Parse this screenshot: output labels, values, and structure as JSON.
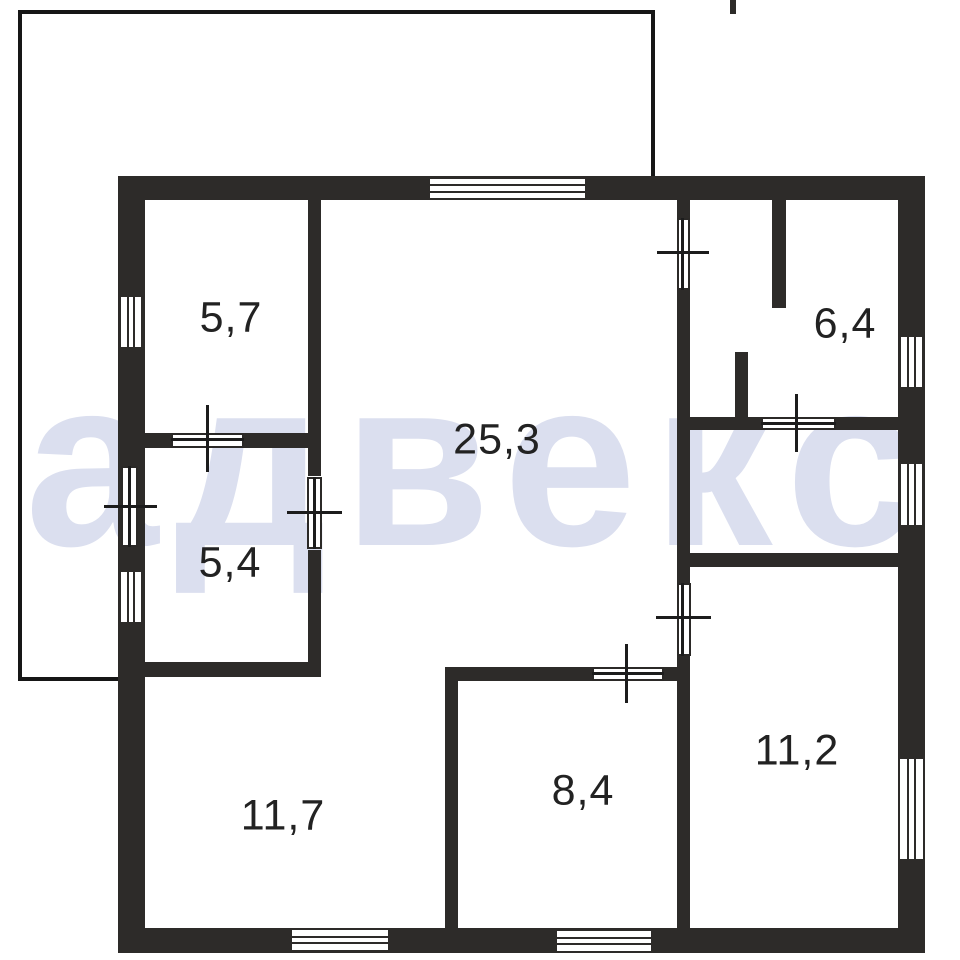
{
  "floor_plan": {
    "watermark": "адвекс",
    "rooms": [
      {
        "key": "5-7",
        "area": "5,7"
      },
      {
        "key": "25-3",
        "area": "25,3"
      },
      {
        "key": "6-4",
        "area": "6,4"
      },
      {
        "key": "5-4",
        "area": "5,4"
      },
      {
        "key": "11-7",
        "area": "11,7"
      },
      {
        "key": "8-4",
        "area": "8,4"
      },
      {
        "key": "11-2",
        "area": "11,2"
      }
    ],
    "colors": {
      "wall": "#2d2b29",
      "watermark": "#dbdfef",
      "background": "#ffffff",
      "label_text": "#222222"
    },
    "symbols": {
      "window": "striped-rectangle",
      "door": "leaf-rectangle-with-axis-cross"
    }
  }
}
